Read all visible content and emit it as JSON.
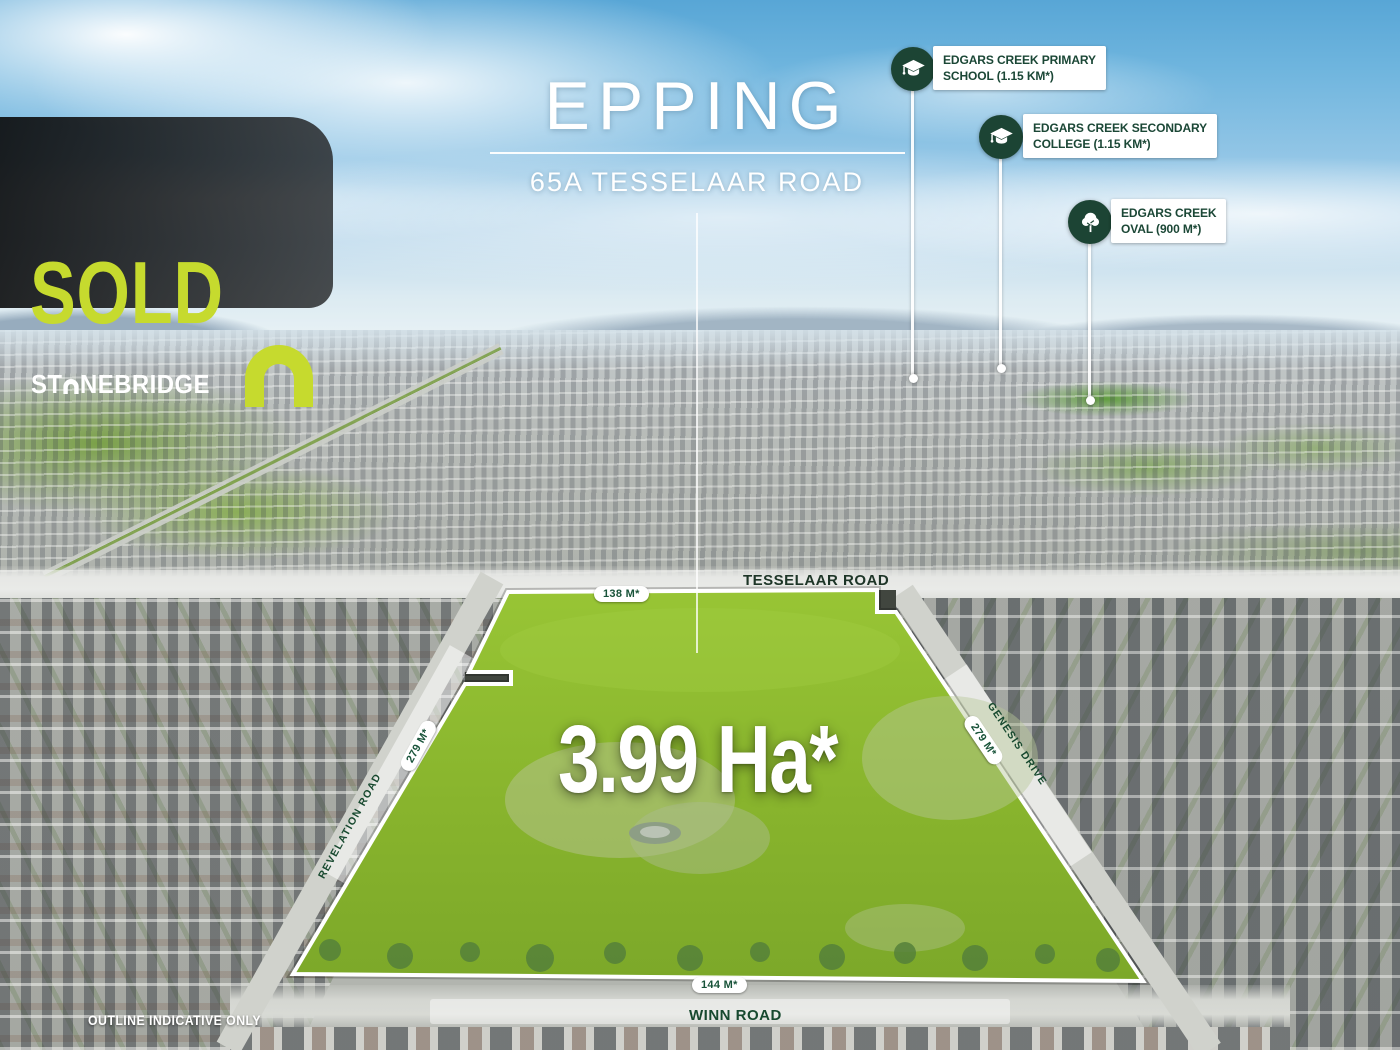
{
  "banner": {
    "sold_label": "SOLD",
    "brand_prefix": "ST",
    "brand_suffix": "NEBRIDGE"
  },
  "header": {
    "suburb": "EPPING",
    "address": "65A TESSELAAR ROAD"
  },
  "land": {
    "area_label": "3.99 Ha*"
  },
  "callouts": {
    "primary_school": {
      "line1": "EDGARS CREEK PRIMARY",
      "line2": "SCHOOL (1.15 KM*)",
      "icon": "graduation-cap-icon"
    },
    "secondary_college": {
      "line1": "EDGARS CREEK SECONDARY",
      "line2": "COLLEGE (1.15 KM*)",
      "icon": "graduation-cap-icon"
    },
    "oval": {
      "line1": "EDGARS CREEK",
      "line2": "OVAL (900 M*)",
      "icon": "tree-icon"
    }
  },
  "roads": {
    "north": "TESSELAAR ROAD",
    "west": "REVELATION ROAD",
    "east": "GENESIS DRIVE",
    "south": "WINN ROAD"
  },
  "measurements": {
    "north": "138 M*",
    "west": "279 M*",
    "east": "279 M*",
    "south": "144 M*"
  },
  "disclaimer": "OUTLINE INDICATIVE ONLY",
  "colors": {
    "brand_lime": "#c6da2e",
    "brand_dark_green": "#1c4434",
    "label_green": "#185339",
    "grass_green": "#8dbb2d"
  }
}
